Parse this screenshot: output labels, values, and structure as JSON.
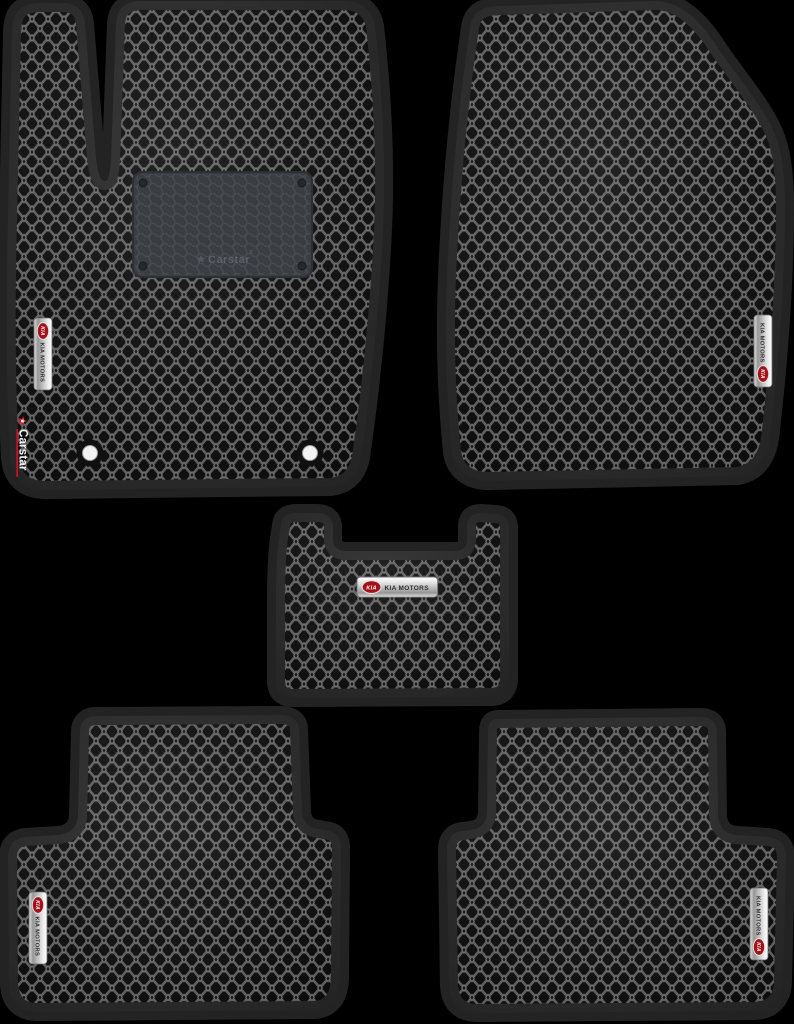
{
  "product": {
    "kia_badge": {
      "logo_text": "KIA",
      "label": "KIA MOTORS"
    },
    "heel_pad": {
      "star_glyph": "★",
      "brand": "Carstar",
      "reg_mark": "®"
    },
    "carstar_tag": {
      "star_glyph": "★",
      "brand": "Carstar"
    },
    "mats": [
      {
        "name": "front-left-driver-mat",
        "badge": "KIA MOTORS",
        "heel_pad_brand": "Carstar",
        "corner_tag": "Carstar",
        "fastener_holes": 2
      },
      {
        "name": "front-right-passenger-mat",
        "badge": "KIA MOTORS"
      },
      {
        "name": "center-tunnel-mat",
        "badge": "KIA MOTORS"
      },
      {
        "name": "rear-left-mat",
        "badge": "KIA MOTORS"
      },
      {
        "name": "rear-right-mat",
        "badge": "KIA MOTORS"
      }
    ]
  },
  "colors": {
    "background": "#000000",
    "mat_border": "#232323",
    "mat_base": "#0a0a0a",
    "lattice": "#5c5c5c",
    "cell_dot": "#6f6f6f",
    "heel_pad_base": "#3a3e43",
    "heel_pad_hex": "#4a4f55",
    "heel_pad_text": "#5c6268",
    "kia_red": "#a31119",
    "carstar_red": "#cf1020",
    "badge_text": "#2e2e2e",
    "hole_white": "#f2f2f2"
  }
}
